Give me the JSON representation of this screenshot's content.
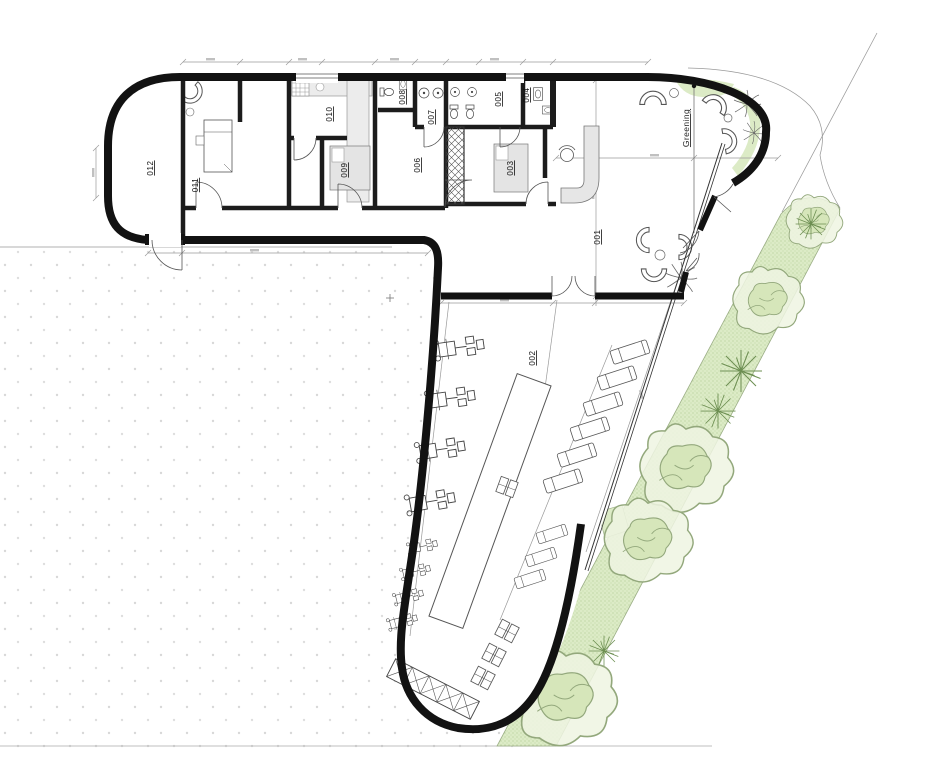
{
  "plan": {
    "room_labels": [
      "001",
      "002",
      "003",
      "004",
      "005",
      "006",
      "007",
      "008",
      "009",
      "010",
      "011",
      "012"
    ],
    "annotations": {
      "greening": "Greening"
    },
    "legend": {
      "type": "architectural-floor-plan",
      "areas": {
        "lobby": "001",
        "terrace": "002"
      }
    },
    "colors": {
      "outline": "#121212",
      "wall": "#1c1c1c",
      "greenery_fill": "#dcebc6",
      "greenery_stroke": "#9aad85",
      "tree_fill": "#eef4e2",
      "tree_inner": "#d6e6ba",
      "furniture_gray": "#e4e4e4",
      "dimension_gray": "#9a9a9a",
      "plaza_dot": "#d8d8d8"
    }
  }
}
